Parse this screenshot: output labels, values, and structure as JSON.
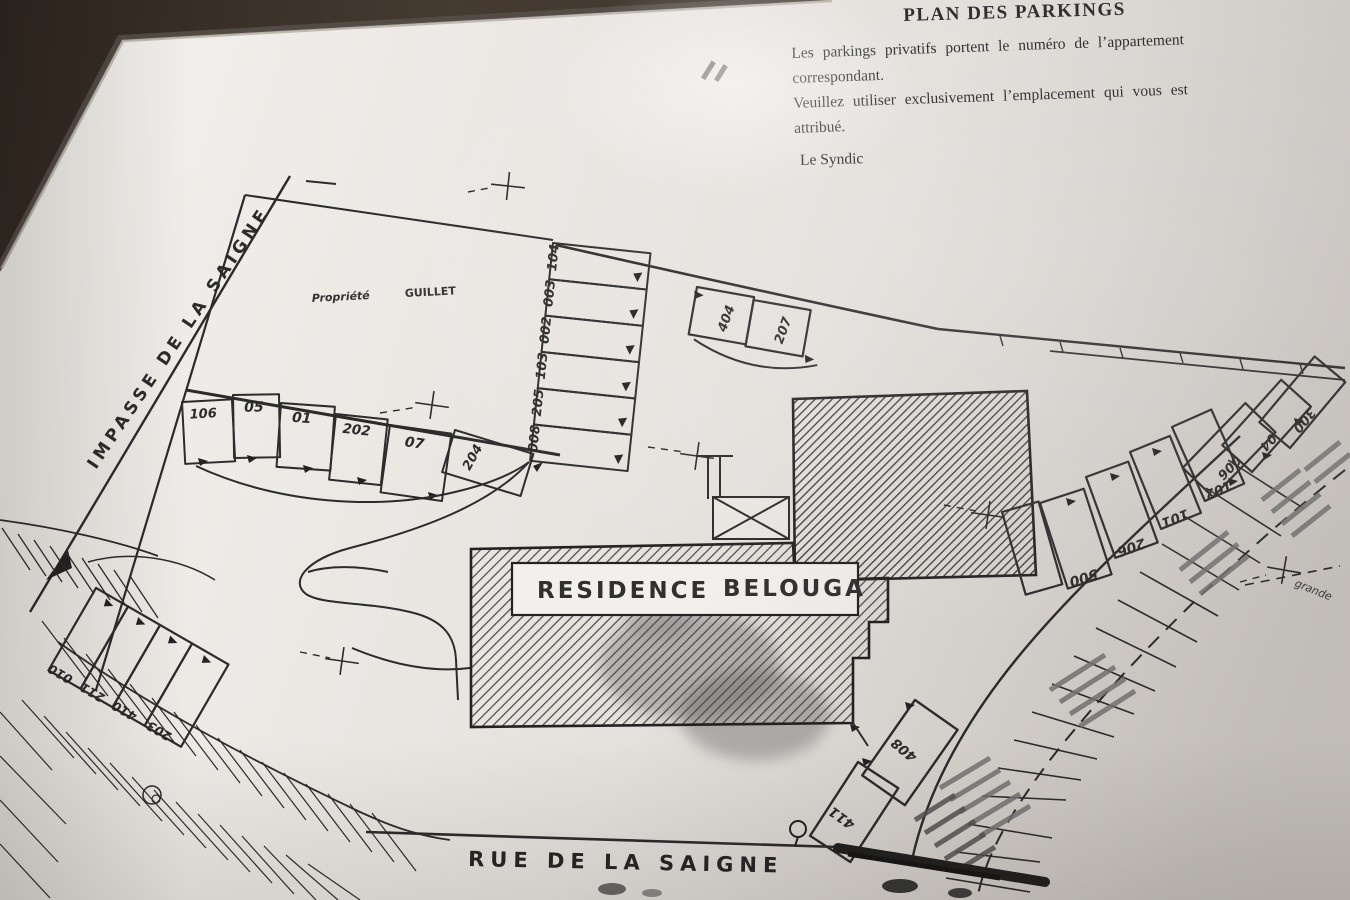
{
  "header": {
    "title": "PLAN DES PARKINGS",
    "notice_line1": "Les parkings privatifs portent le numéro de l’appartement",
    "notice_line2": "correspondant.",
    "notice_line3": "Veuillez utiliser exclusivement l’emplacement qui vous est",
    "notice_line4": "attribué.",
    "signature": "Le Syndic"
  },
  "streets": {
    "impasse": "IMPASSE  DE  LA  SAIGNE",
    "rue": "RUE  DE  LA  SAIGNE"
  },
  "property": {
    "label": "Propriété",
    "owner": "GUILLET"
  },
  "building": {
    "word1": "RESIDENCE",
    "word2": "BELOUGA"
  },
  "annotations": {
    "grande": "grande"
  },
  "spots": {
    "left_row": [
      "106",
      "05",
      "01",
      "202",
      "07",
      "204"
    ],
    "strip_top_to_bottom": [
      "104",
      "003",
      "002",
      "103",
      "205",
      "008"
    ],
    "top_middle": [
      "404",
      "207"
    ],
    "right_row": [
      "500",
      "206",
      "101",
      "102"
    ],
    "right_cluster": [
      "006",
      "04",
      "300"
    ],
    "left_lower": [
      "010",
      "211",
      "410",
      "203"
    ],
    "bottom": [
      "408",
      "411"
    ]
  },
  "colors": {
    "frame": "#3a312a",
    "paper": "#e9e6e2",
    "ink": "#2a2a2a"
  }
}
